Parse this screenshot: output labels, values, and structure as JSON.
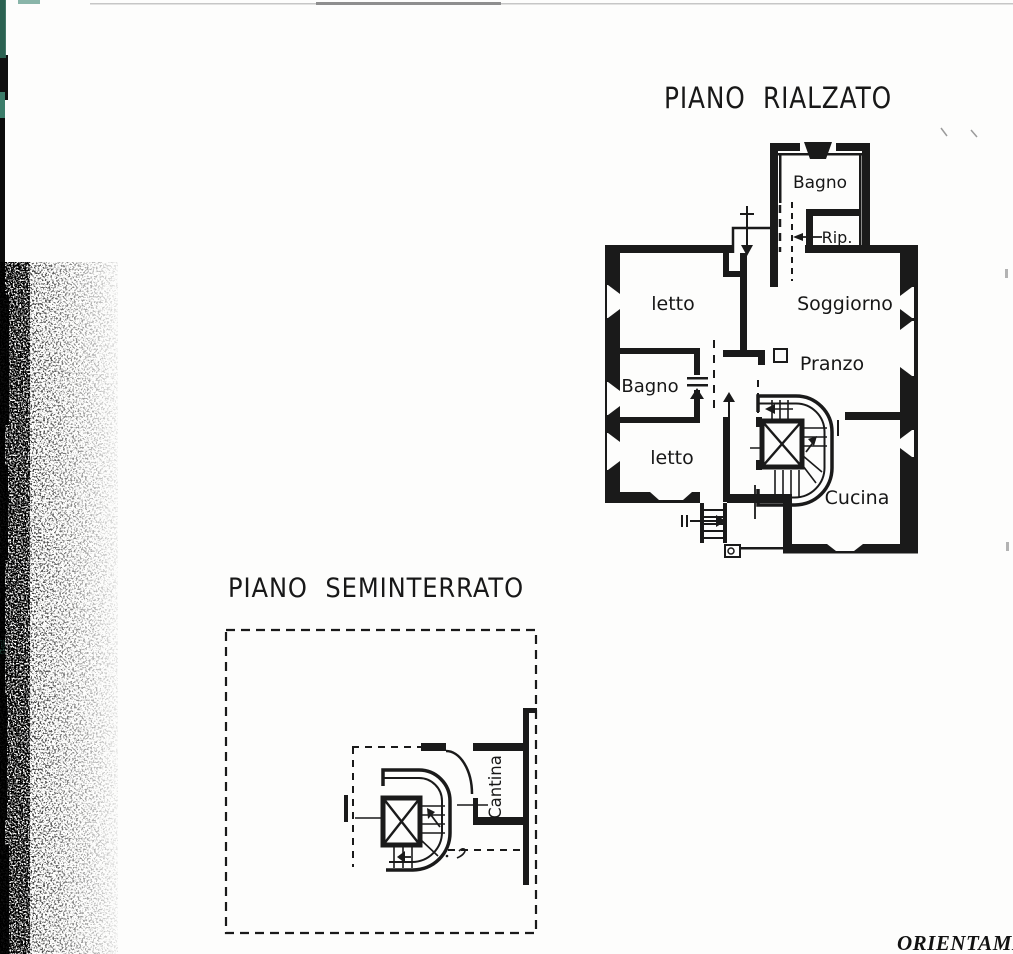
{
  "plans": {
    "rialzato": {
      "title": "PIANO RIALZATO",
      "rooms": {
        "bagno_top": "Bagno",
        "rip": "Rip.",
        "letto_1": "letto",
        "soggiorno": "Soggiorno",
        "pranzo": "Pranzo",
        "bagno": "Bagno",
        "letto_2": "letto",
        "cucina": "Cucina"
      }
    },
    "seminterrato": {
      "title": "PIANO SEMINTERRATO",
      "rooms": {
        "cantina": "Cantina"
      }
    }
  },
  "footer": {
    "orientation_text_partial": "ORIENTAMEN"
  },
  "colors": {
    "ink": "#1a1a1a",
    "paper": "#fdfdfc",
    "scan_strip": "#0c0c0c",
    "scan_teal": "#2f6a59"
  }
}
